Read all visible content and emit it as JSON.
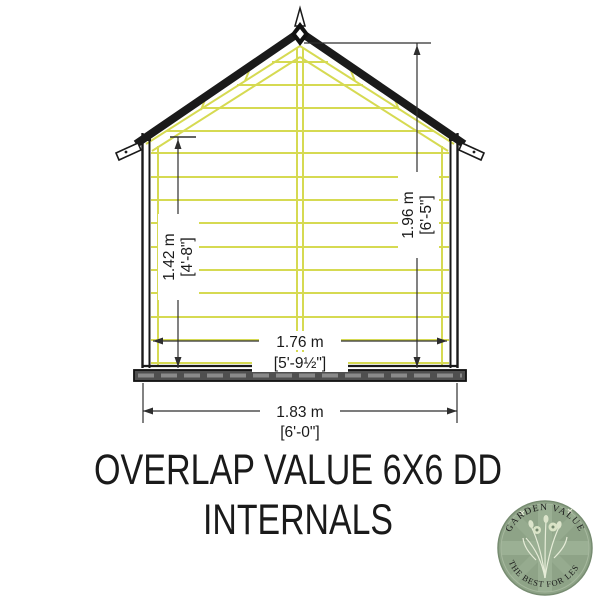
{
  "title": {
    "line1": "OVERLAP VALUE 6X6 DD",
    "line2": "INTERNALS"
  },
  "diagram": {
    "name": "shed-front-elevation-internals",
    "dimensions": {
      "wall_height": {
        "metric": "1.42 m",
        "imperial": "[4'-8\"]"
      },
      "ridge_height": {
        "metric": "1.96 m",
        "imperial": "[6'-5\"]"
      },
      "internal_width": {
        "metric": "1.76 m",
        "imperial": "[5'-9½\"]"
      },
      "external_width": {
        "metric": "1.83 m",
        "imperial": "[6'-0\"]"
      }
    },
    "colors": {
      "cladding_line": "#d6da52",
      "outline": "#1a1a1a",
      "base_fill": "#4f4f4f",
      "dimension_line": "#2e2e2e"
    }
  },
  "logo": {
    "top_text": "GARDEN VALUE",
    "bottom_text": "THE BEST FOR LESS",
    "circle_color": "#8ea387",
    "text_color": "#eef2e2"
  }
}
